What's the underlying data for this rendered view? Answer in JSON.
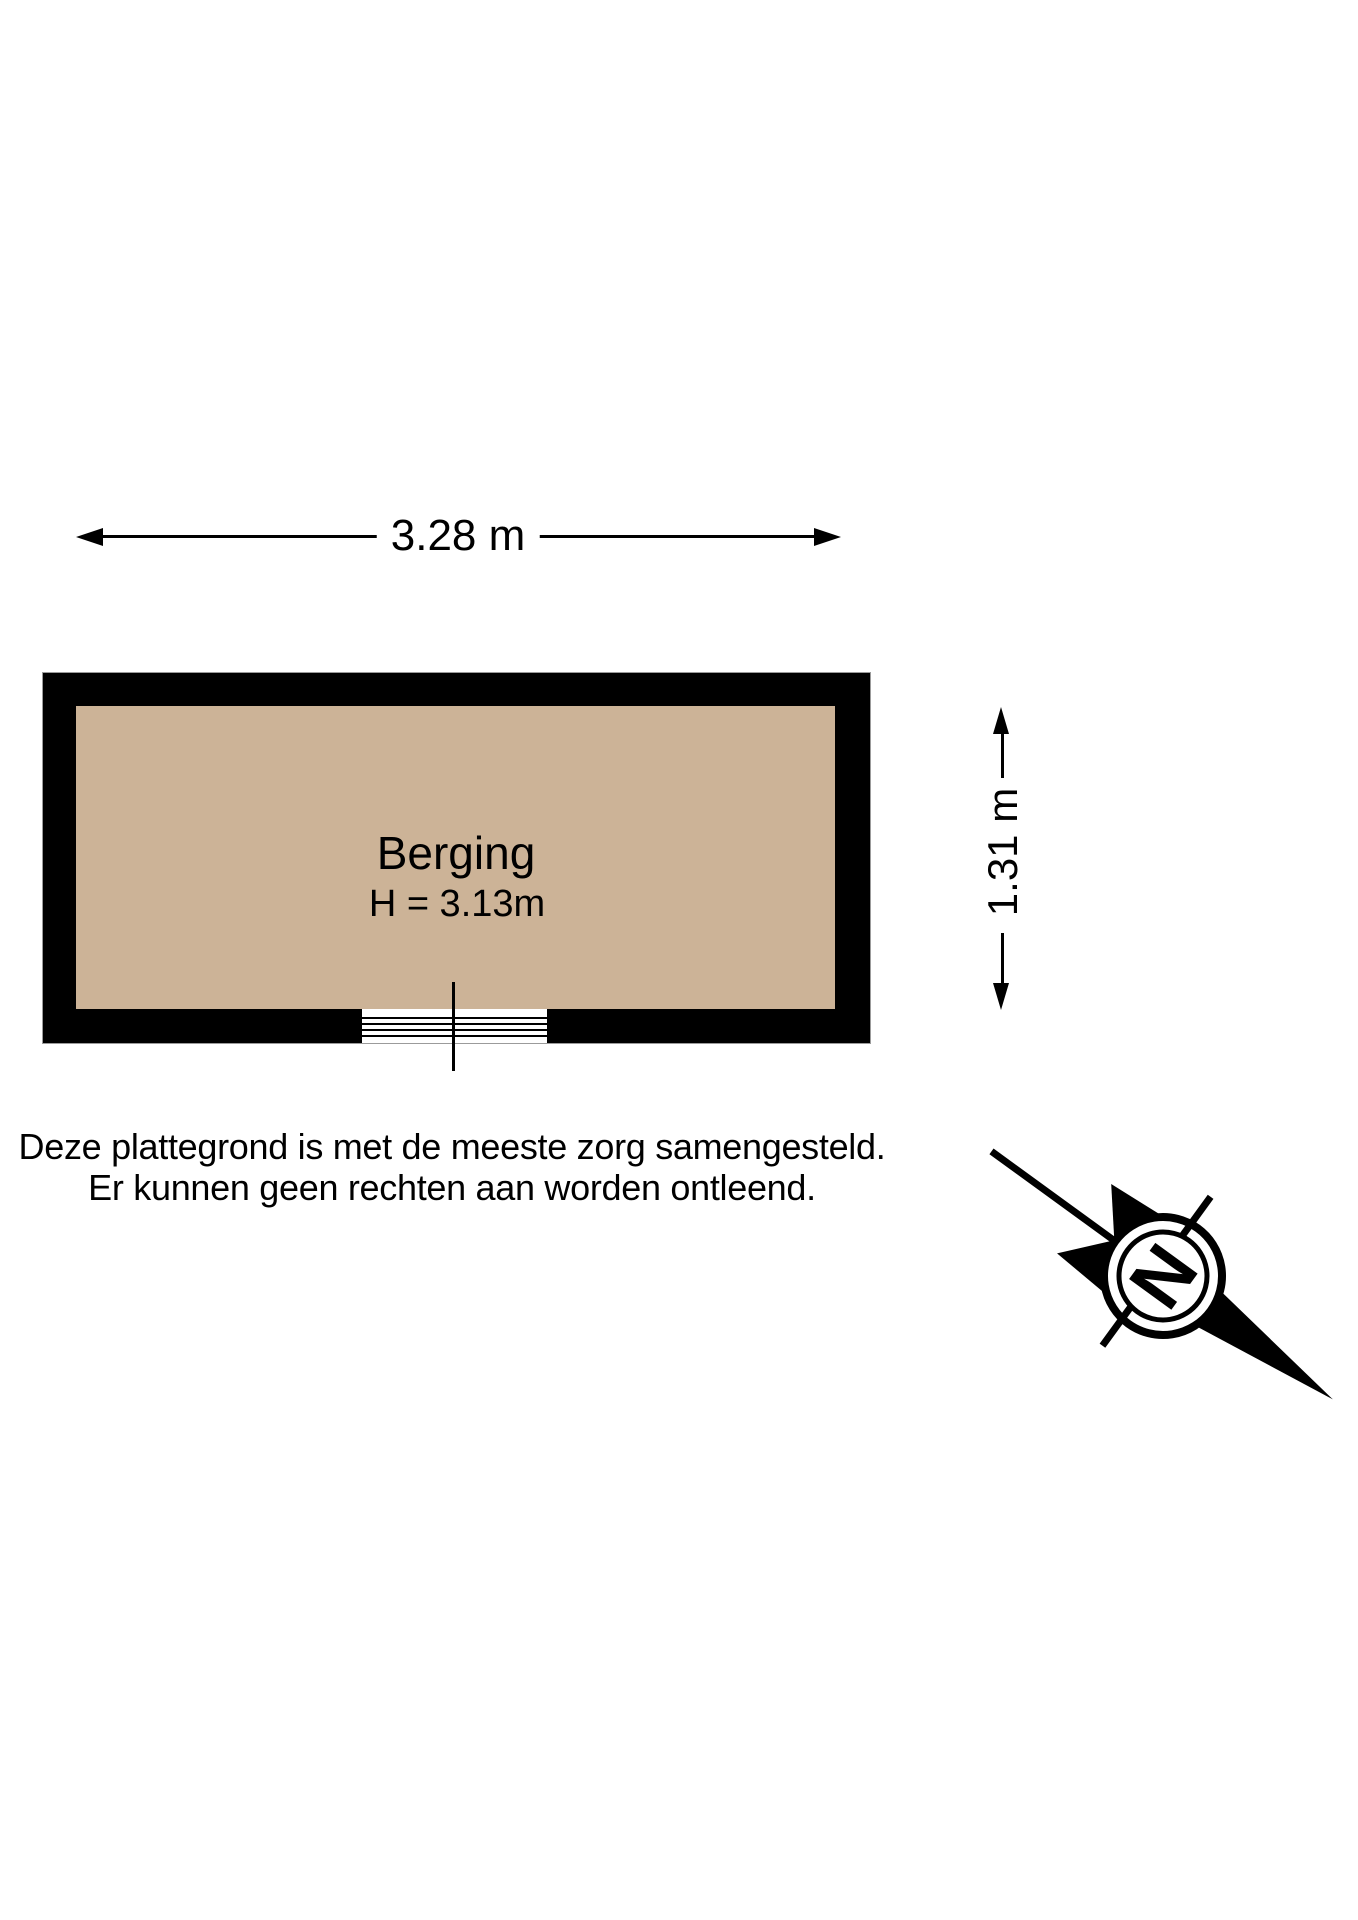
{
  "floorplan": {
    "room": {
      "name": "Berging",
      "ceiling_height_label": "H = 3.13m"
    },
    "dimensions": {
      "width": "3.28 m",
      "depth": "1.31 m"
    },
    "door": {
      "type": "opening-with-threshold",
      "threshold_line_count": 4
    },
    "compass": {
      "label": "N"
    },
    "disclaimer": [
      "Deze plattegrond is met de meeste zorg samengesteld.",
      "Er kunnen geen rechten aan worden ontleend."
    ],
    "colors": {
      "floor": "#CCB397",
      "wall": "#000000",
      "background": "#FFFFFF"
    }
  }
}
